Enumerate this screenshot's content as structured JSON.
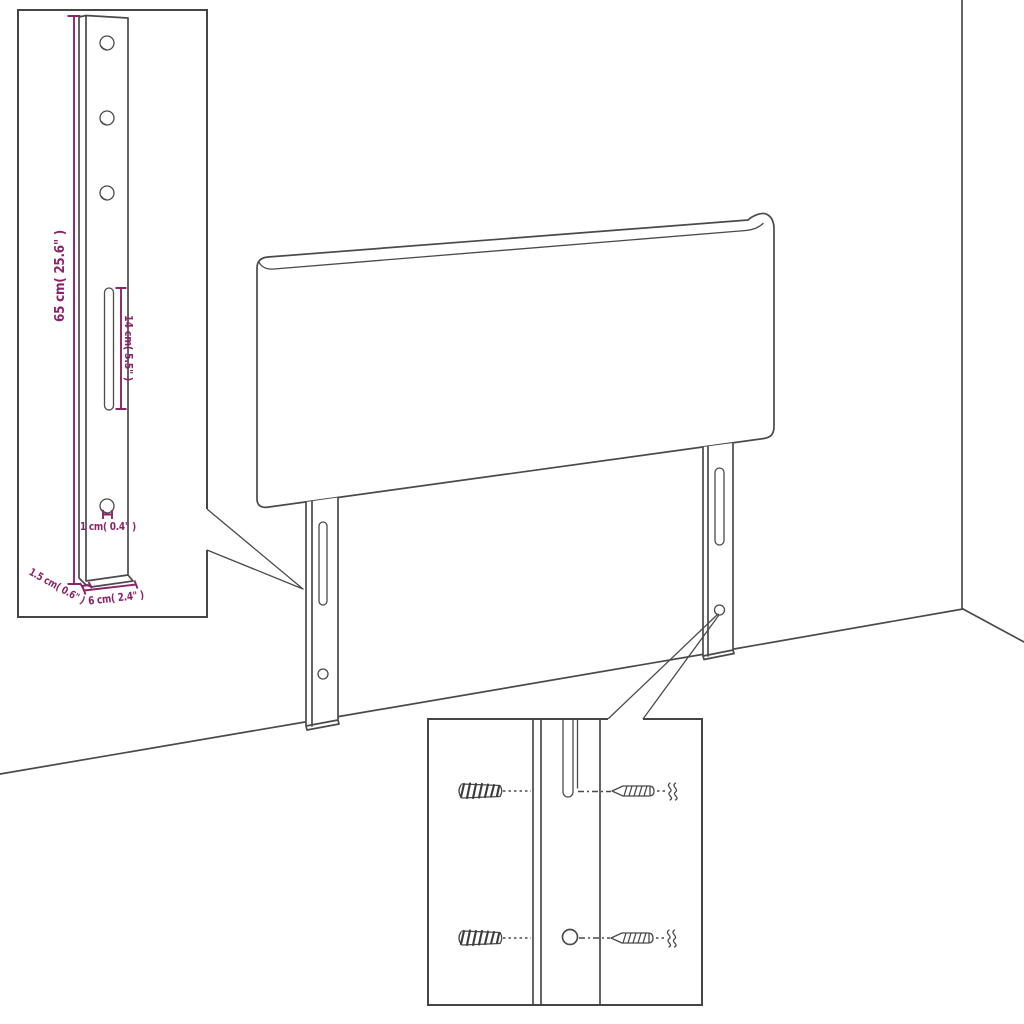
{
  "colors": {
    "line": "#4a4a4a",
    "dimension": "#8b2369",
    "background": "#ffffff"
  },
  "bracket_inset": {
    "labels": {
      "height": "65 cm( 25.6\" )",
      "slot": "14 cm( 5.5\" )",
      "hole": "1 cm( 0.4\" )",
      "thickness": "1.5 cm( 0.6\" )",
      "width": "6 cm( 2.4\" )"
    },
    "hole_count": 4,
    "slot_count": 1
  },
  "screw_inset": {
    "anchor_count": 2,
    "screw_count": 2,
    "hole_count": 1,
    "slot_count": 1
  },
  "main_drawing": {
    "leg_count": 2,
    "panel": "headboard"
  }
}
